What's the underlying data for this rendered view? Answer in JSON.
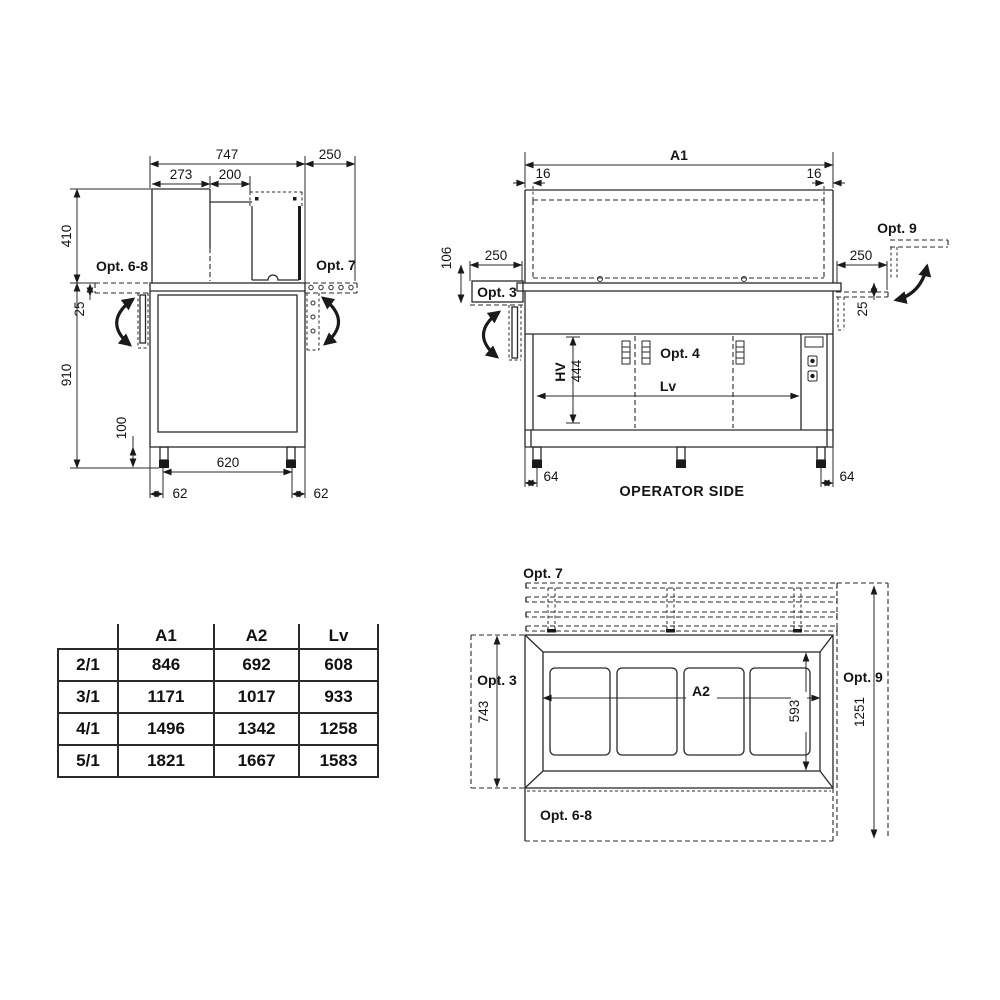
{
  "side_view": {
    "dims": {
      "depth_total": "747",
      "shelf_right_width": "250",
      "glass_offset": "273",
      "glass_width": "200",
      "superstructure_height": "410",
      "shelf_drop": "25",
      "body_height": "910",
      "leg_height": "100",
      "leg_span": "620",
      "leg_offset": "62"
    },
    "labels": {
      "opt_6_8": "Opt. 6-8",
      "opt_7": "Opt. 7"
    }
  },
  "front_view": {
    "dims": {
      "overall_width_code": "A1",
      "wall_inset": "16",
      "shelf_height": "106",
      "shelf_width": "250",
      "shelf_drop": "25",
      "door_height_code": "HV",
      "door_height": "444",
      "useful_width_code": "Lv",
      "leg_offset": "64"
    },
    "labels": {
      "opt_3": "Opt. 3",
      "opt_4": "Opt. 4",
      "opt_9": "Opt. 9",
      "operator_side": "OPERATOR SIDE"
    }
  },
  "top_view": {
    "dims": {
      "depth_with_shelf": "743",
      "useful_top_width_code": "A2",
      "well_area_depth": "593",
      "total_depth": "1251"
    },
    "labels": {
      "opt_7": "Opt. 7",
      "opt_3": "Opt. 3",
      "opt_9": "Opt. 9",
      "opt_6_8": "Opt. 6-8"
    }
  },
  "spec_table": {
    "columns": [
      "",
      "A1",
      "A2",
      "Lv"
    ],
    "rows": [
      [
        "2/1",
        "846",
        "692",
        "608"
      ],
      [
        "3/1",
        "1171",
        "1017",
        "933"
      ],
      [
        "4/1",
        "1496",
        "1342",
        "1258"
      ],
      [
        "5/1",
        "1821",
        "1667",
        "1583"
      ]
    ]
  }
}
